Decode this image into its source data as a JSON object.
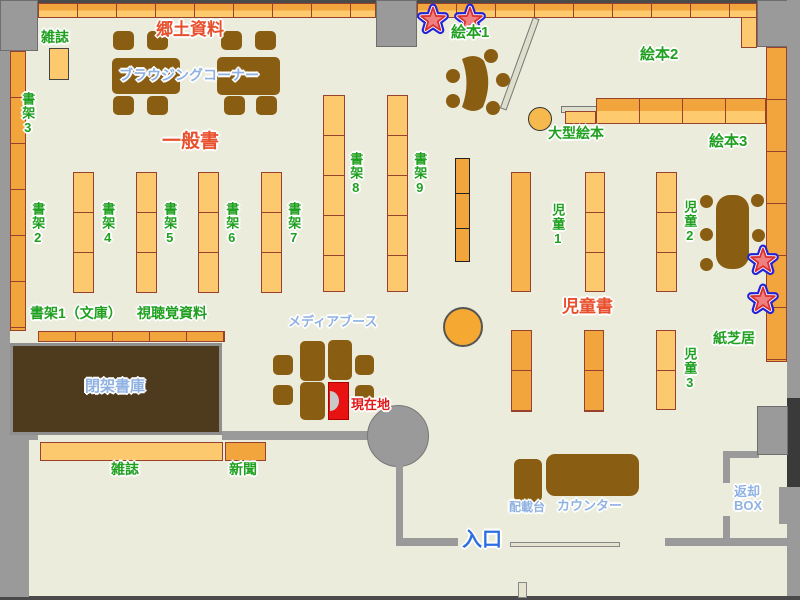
{
  "map_type": "library-floor-map",
  "labels": {
    "magazines_top": "雑誌",
    "local_materials": "郷土資料",
    "browsing_corner": "ブラウジングコーナー",
    "general_books": "一般書",
    "shelf1_bunko": "書架1（文庫）",
    "shelf2": "書架2",
    "shelf3": "書架3",
    "shelf4": "書架4",
    "shelf5": "書架5",
    "shelf6": "書架6",
    "shelf7": "書架7",
    "shelf8": "書架8",
    "shelf9": "書架9",
    "audio_visual": "視聴覚資料",
    "picture_book1": "絵本1",
    "picture_book2": "絵本2",
    "picture_book3": "絵本3",
    "large_picture_books": "大型絵本",
    "children1": "児童1",
    "children2": "児童2",
    "children3": "児童3",
    "children_books": "児童書",
    "kamishibai": "紙芝居",
    "media_booth": "メディアブース",
    "current_location": "現在地",
    "closed_stacks": "閉架書庫",
    "magazines_bottom": "雑誌",
    "newspapers": "新聞",
    "entrance": "入口",
    "loading_stand": "配載台",
    "counter": "カウンター",
    "return_box_line1": "返却",
    "return_box_line2": "BOX"
  },
  "icons": {
    "star_marker": "star-icon",
    "star_glyph": "★",
    "current_location_marker": "current-location-marker"
  },
  "colors": {
    "background": "#ECECDC",
    "wall_gray": "#9A9A9A",
    "shelf_light": "#FDC96E",
    "shelf_dark": "#F1A53C",
    "shelf_border": "#97422F",
    "table_brown": "#8A5E12",
    "closed_stack_brown": "#4E3A1D",
    "label_green": "#1FA01F",
    "label_red": "#E8502D",
    "label_light_blue": "#8FB2E2",
    "entrance_blue": "#2E6FE0",
    "marker_red": "#E81212",
    "star_fill": "#F08080",
    "star_outline": "#2222D8"
  }
}
